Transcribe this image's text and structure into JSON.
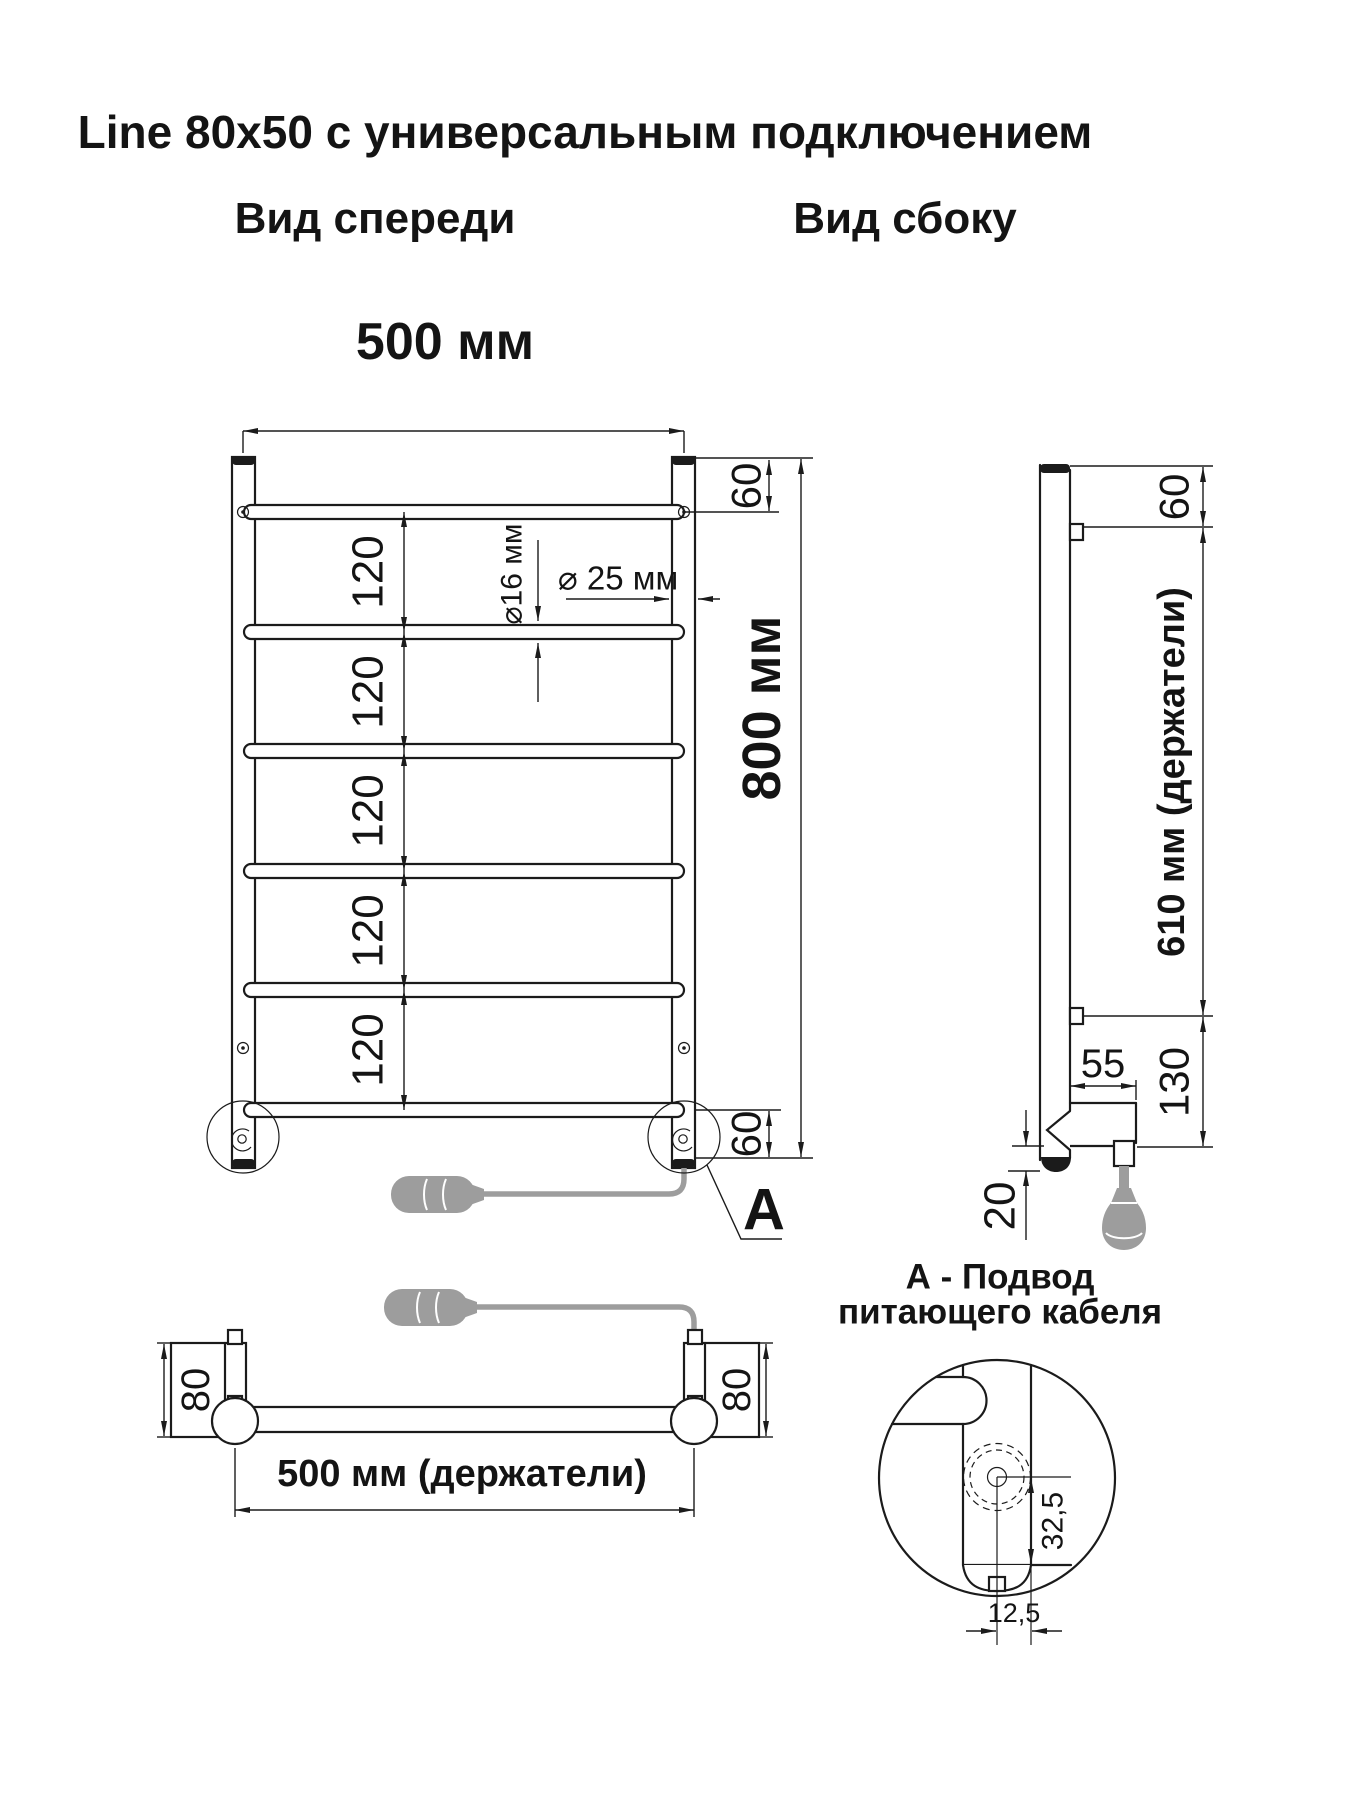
{
  "page": {
    "background": "#ffffff",
    "ink": "#1b1b1b",
    "plug_gray": "#9d9d9d"
  },
  "title": "Line 80x50 с универсальным подключением",
  "front_view": {
    "label": "Вид спереди",
    "width": "500 мм",
    "height": "800 мм",
    "top_gap": "60",
    "bottom_gap": "60",
    "bar_gaps": [
      "120",
      "120",
      "120",
      "120",
      "120"
    ],
    "bar_diameter": "⌀16 мм",
    "post_diameter": "⌀ 25 мм",
    "callout_label": "A"
  },
  "side_view": {
    "label": "Вид сбоку",
    "top_gap": "60",
    "holders_span": "610 мм (держатели)",
    "bracket_depth": "55",
    "bottom_span": "130",
    "cable_drop": "20"
  },
  "bottom_view": {
    "left_depth": "80",
    "right_depth": "80",
    "holders_span": "500 мм (держатели)"
  },
  "detail_a": {
    "title_line1": "А - Подвод",
    "title_line2": "питающего кабеля",
    "dim_vertical": "32,5",
    "dim_horizontal": "12,5"
  }
}
